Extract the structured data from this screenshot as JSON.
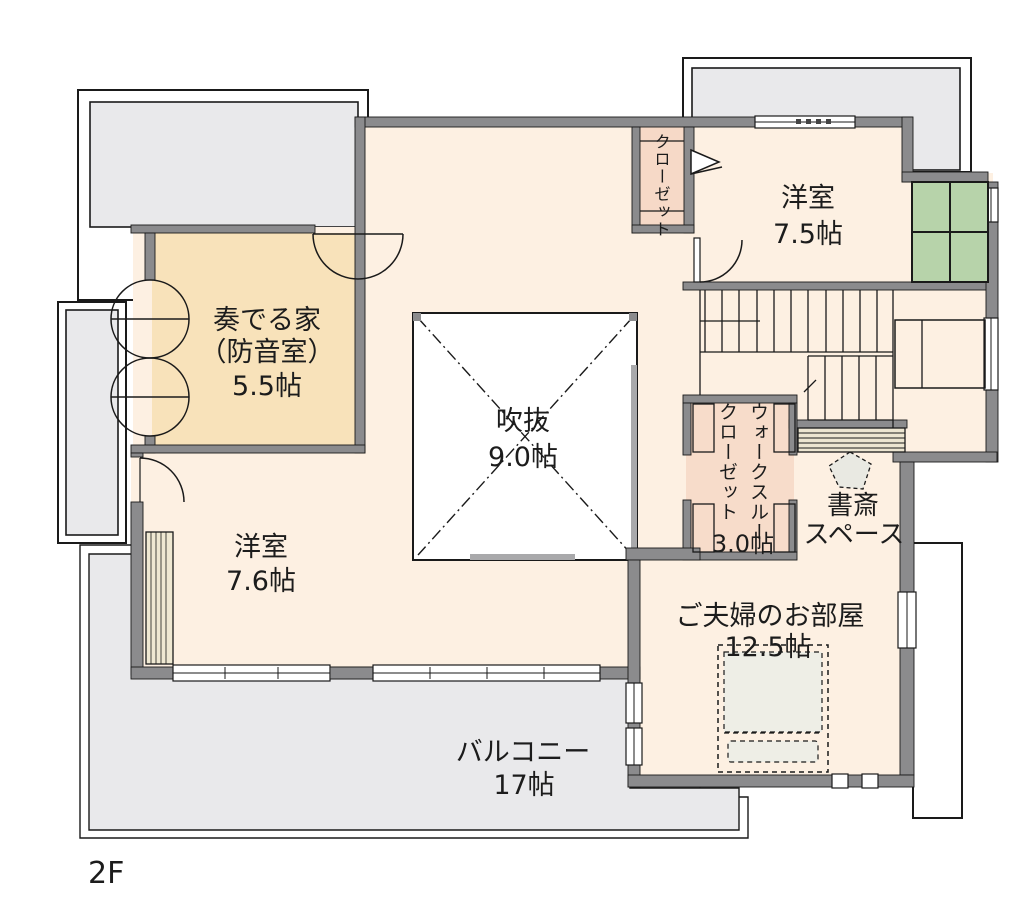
{
  "floor_label": "2F",
  "rooms": {
    "soundproof_room": {
      "name_line1": "奏でる家",
      "name_line2": "（防音室）",
      "area": "5.5帖"
    },
    "closet": {
      "name": "クローゼット"
    },
    "western_room_75": {
      "name": "洋室",
      "area": "7.5帖"
    },
    "atrium": {
      "name": "吹抜",
      "area": "9.0帖"
    },
    "western_room_76": {
      "name": "洋室",
      "area": "7.6帖"
    },
    "walk_through_closet": {
      "name_line1": "ウォークスルー",
      "name_line2": "クローゼット",
      "area": "3.0帖"
    },
    "study_space": {
      "name_line1": "書斎",
      "name_line2": "スペース"
    },
    "master_bedroom": {
      "name": "ご夫婦のお部屋",
      "area": "12.5帖"
    },
    "balcony": {
      "name": "バルコニー",
      "area": "17帖"
    }
  },
  "colors": {
    "room_floor": "#fdf0e2",
    "soundproof_floor": "#f8e2ba",
    "closet_floor": "#f6d9c7",
    "balcony_roof_gray": "#e9e9eb",
    "wall_gray": "#8b8b8d",
    "green_counter": "#b7d3aa",
    "counter_tan": "#ece5d1",
    "bed_fill": "#eeeee6"
  }
}
